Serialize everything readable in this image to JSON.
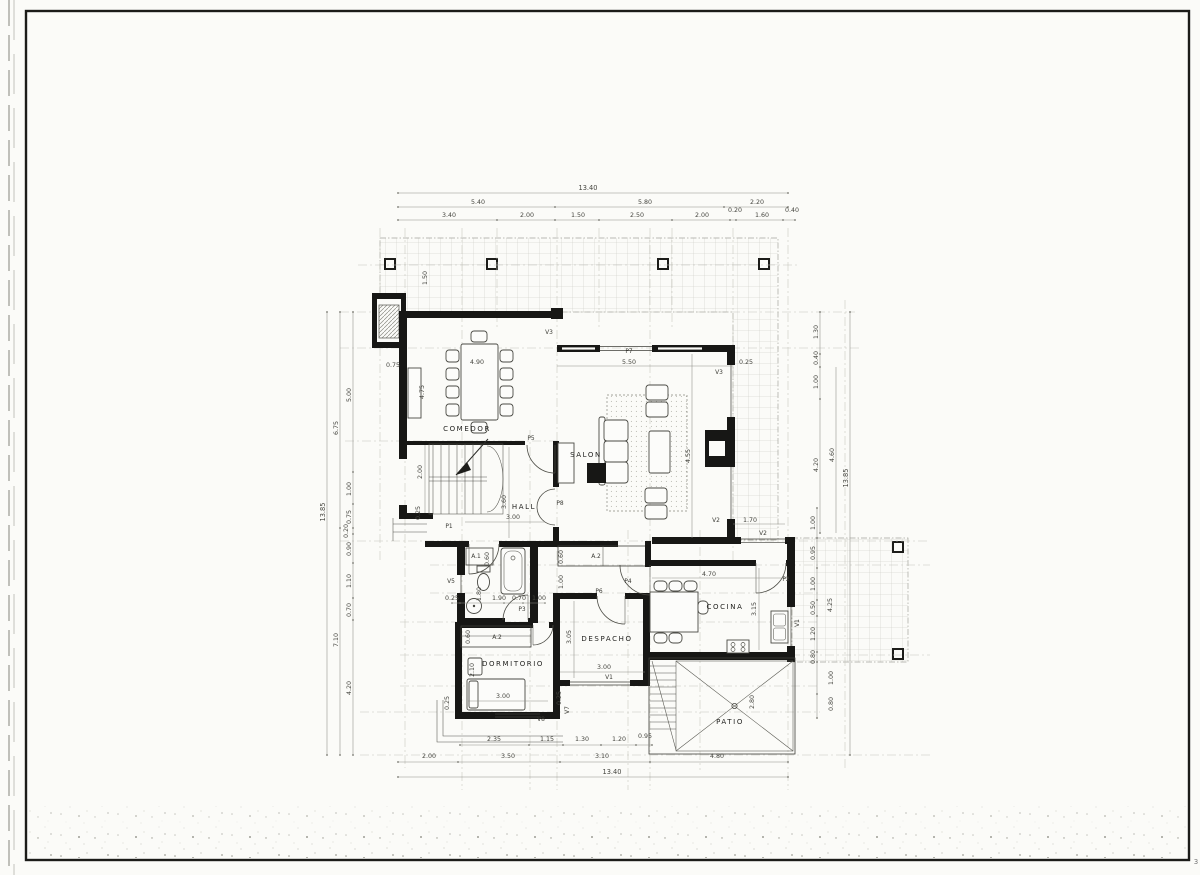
{
  "sheet": {
    "corner_mark": "3"
  },
  "rooms": {
    "comedor": "COMEDOR",
    "salon": "SALON",
    "hall": "HALL",
    "despacho": "DESPACHO",
    "dormitorio": "DORMITORIO",
    "cocina": "COCINA",
    "patio": "PATIO"
  },
  "doors": {
    "p1": "P1",
    "p2": "P2",
    "p3": "P3",
    "p4": "P4",
    "p5": "P5",
    "p6": "P6",
    "p7": "P7",
    "p8": "P8"
  },
  "windows": {
    "v1": "V1",
    "v2": "V2",
    "v3": "V3",
    "v5": "V5",
    "v7": "V7",
    "v8": "V8"
  },
  "closets": {
    "a1": "A.1",
    "a2": "A.2"
  },
  "dims": {
    "top": {
      "total": "13.40",
      "mid": [
        "5.40",
        "5.80",
        "2.20"
      ],
      "inner": [
        "3.40",
        "2.00",
        "1.50",
        "2.50",
        "2.00",
        "0.20",
        "1.60",
        "0.40"
      ]
    },
    "bottom": {
      "total": "13.40",
      "mid": [
        "2.00",
        "3.50",
        "3.10",
        "4.80"
      ],
      "inner": [
        "2.35",
        "1.15",
        "1.30",
        "1.20",
        "0.95"
      ]
    },
    "left": {
      "total": "13.85",
      "mid": [
        "6.75",
        "7.10"
      ],
      "inner": [
        "5.00",
        "1.00",
        "0.75",
        "0.20",
        "0.90",
        "1.10",
        "0.70",
        "4.20"
      ]
    },
    "right": {
      "total": "13.85",
      "upper": [
        "1.30",
        "0.40",
        "1.00",
        "4.20",
        "4.60"
      ],
      "terrace": [
        "1.00",
        "0.95",
        "1.00",
        "0.50",
        "1.20",
        "0.80",
        "4.25",
        "1.00",
        "0.80"
      ]
    },
    "interior": {
      "comedor_table": "4.90",
      "comedor_height": "4.75",
      "comedor_offset": "0.75",
      "porch_column": "1.50",
      "stair_width": "2.00",
      "entry_jamb": "0.25",
      "salon_front": "5.50",
      "salon_depth": "4.55",
      "salon_jamb": "0.25",
      "hall_width": "3.00",
      "hall_depth": "3.60",
      "bath_row": [
        "0.25",
        "1.90",
        "0.70",
        "1.00"
      ],
      "bath_depth": "1.80",
      "closet_depth": "0.60",
      "corridor_width": "1.00",
      "despacho_depth": "3.05",
      "despacho_width": "3.00",
      "despacho_jamb": "0.25",
      "dorm_bed": "3.00",
      "dorm_side": "2.10",
      "dorm_jamb": "0.25",
      "cocina_width": "4.70",
      "cocina_depth": "3.15",
      "kitchen_window": "1.70",
      "patio_half": "2.80"
    }
  }
}
